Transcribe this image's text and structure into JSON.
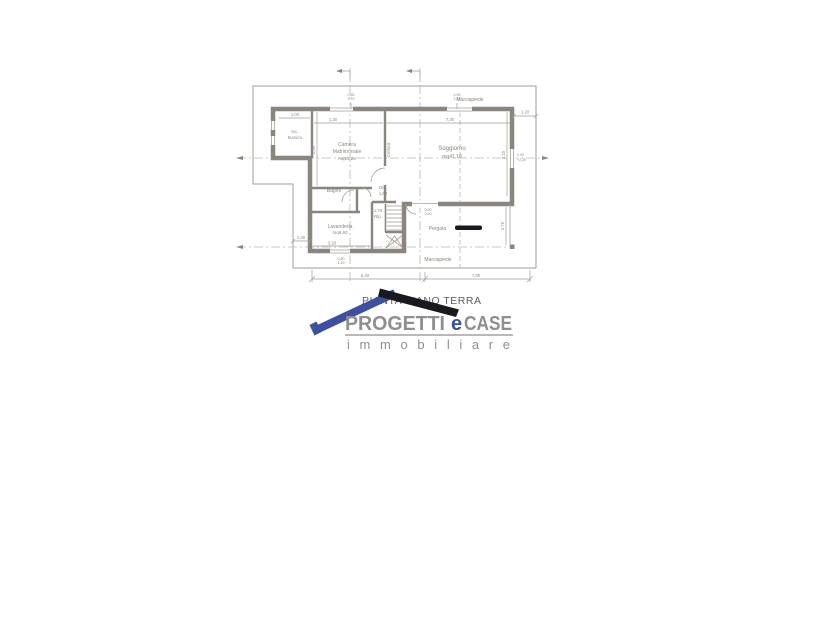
{
  "document": {
    "caption": "PIANTA PIANO TERRA"
  },
  "plan": {
    "sidewalk_top": "Marciapiede",
    "sidewalk_bottom": "Marciapiede",
    "rooms": {
      "loc_tecnico_1": "loc.",
      "loc_tecnico_2": "tecnico",
      "camera_1": "Camera",
      "camera_2": "Matrimoniale",
      "camera_area": "mq13,28",
      "cottura": "Cottura",
      "soggiorno": "Soggiorno",
      "soggiorno_area": "mq41,10",
      "bagno": "Bagno",
      "dis": "Dis.",
      "dis_h": "1,80",
      "rip": "Rip.",
      "rip_h": "1,70",
      "lavanderia": "Lavanderia",
      "lavanderia_area": "mq6,60",
      "pergola": "Pergola"
    },
    "dims": {
      "top_right": "1,20",
      "left": "1,30",
      "bottom_left": "5,40",
      "bottom_right": "7,80",
      "loc_top": "1,00",
      "camera_top": "1,30",
      "sogg_top": "7,30",
      "camera_left": "4,50",
      "sogg_right": "5,10",
      "lav_bottom": "3,20",
      "pergola_h": "1,75",
      "win1_a": "0,80",
      "win1_b": "2,70",
      "win2_a": "0,90",
      "win2_b": "2,70",
      "win3_a": "0,80",
      "win3_b": "1,20",
      "door_a": "0,90",
      "door_b": "2,40",
      "winr_a": "1,00",
      "winr_b": "+2,20"
    }
  },
  "logo": {
    "name_1": "PROGETTI",
    "name_accent": "e",
    "name_2": "CASE",
    "tagline": "immobiliare"
  },
  "colors": {
    "line": "#a39e96",
    "wall": "#8a857d",
    "text": "#8b867e",
    "centerline": "#bcb8b0",
    "logo_gray": "#8f8f8f",
    "logo_blue": "#3d4fa1",
    "logo_dark": "#191920",
    "caption_gray": "#5d5d5d"
  }
}
